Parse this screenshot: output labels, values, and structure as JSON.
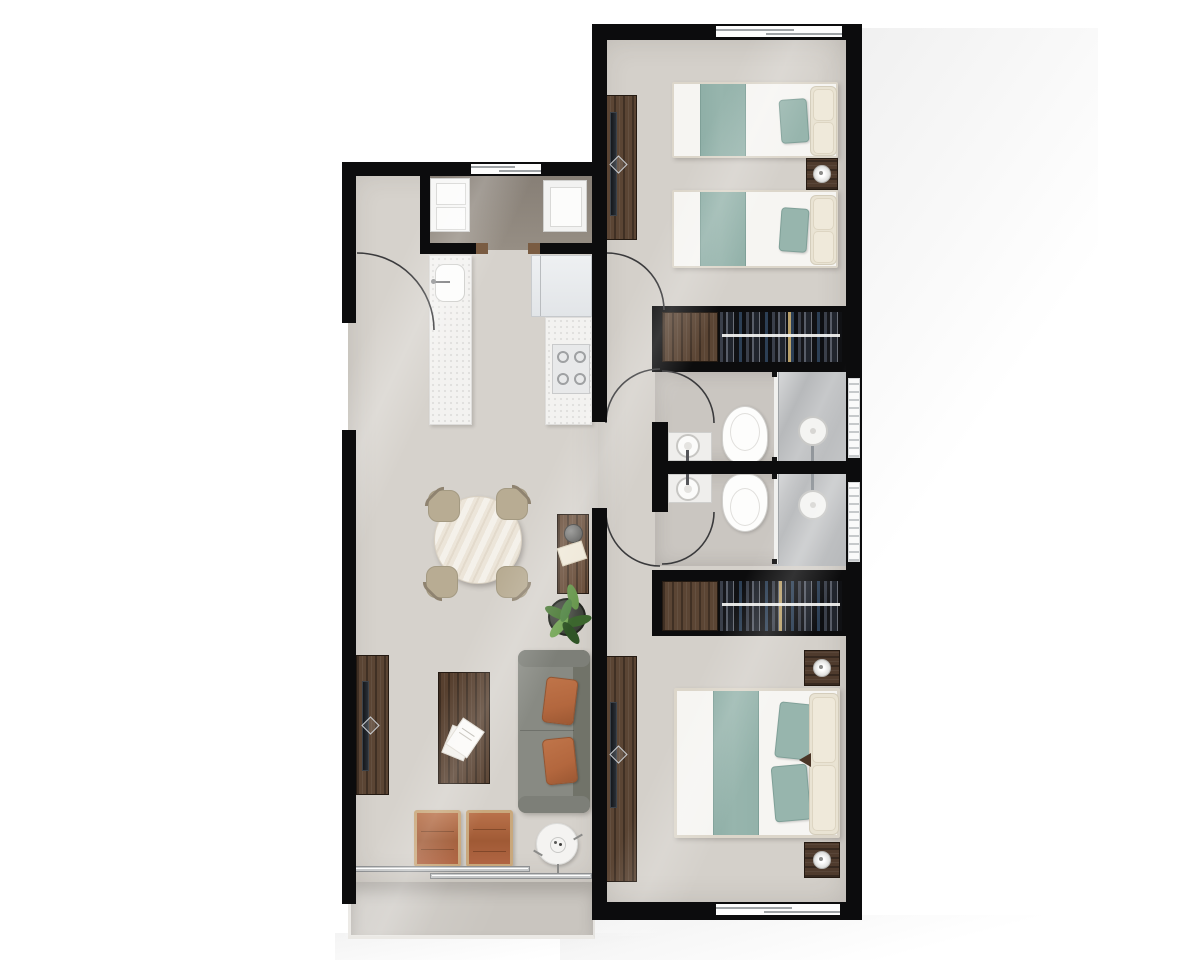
{
  "meta": {
    "title": "Two-bedroom apartment floor plan — photorealistic top-down 3D render",
    "view": "top-down",
    "text_on_image": "none"
  },
  "palette": {
    "bg": "#ffffff",
    "wall": "#0c0c0d",
    "floor": "#d6d2cc",
    "floor_right": "#d4d0ca",
    "laundry_floor": "#968e84",
    "bath_floor": "#cac6c1",
    "shower_floor": "#b7b9bb",
    "balcony_floor": "#c9c5bf",
    "wood": "#5b4534",
    "wood_dark": "#241a12",
    "wood_mid": "#6a4f3b",
    "teal": "#97b5ad",
    "teal_dark": "#7fa098",
    "cream": "#e9e3d3",
    "bed_white": "#f6f5f2",
    "sofa": "#888a83",
    "sofa_dark": "#717369",
    "orange": "#b3673e",
    "orange_dark": "#96542f",
    "tan": "#c9a87c",
    "chair": "#b8ac93",
    "chair_dark": "#8f8370",
    "counter": "#f3f2f0",
    "table": "#ece5d9",
    "plant": "#4f7d3b",
    "plant_dark": "#2f5426",
    "glass_line": "#9fa3a6",
    "arc": "#3a3a3c",
    "lamp_ring": "#b5b5b3"
  },
  "labels": {
    "plan": "Apartment floor plan",
    "bedroom1": "Bedroom with two twin beds",
    "bedroom2": "Master bedroom",
    "bath": "Bathroom",
    "kitchen": "Kitchen",
    "laundry": "Laundry nook",
    "dining": "Dining area",
    "living": "Living room",
    "balcony": "Balcony",
    "hallway": "Hallway",
    "twin_bed": "Twin bed with teal runner",
    "double_bed": "Double bed with teal runner",
    "wardrobe": "Built-in wardrobe with hanging clothes",
    "tv_console": "TV console",
    "nightstand": "Nightstand with lamp",
    "toilet": "Toilet",
    "vanity": "Vanity sink",
    "shower": "Glass shower with rain head",
    "washer": "Washing machine",
    "heater": "Utility appliance",
    "fridge": "Refrigerator",
    "stove": "Gas cooktop counter",
    "kitchen_sink": "Kitchen sink counter",
    "dining_table": "Round dining table",
    "chair": "Dining chair",
    "console_table": "Console table with decor",
    "plant": "Potted plant",
    "sofa": "Sofa with terracotta cushions",
    "coffee_table": "Coffee table with magazines",
    "ottoman": "Leather ottoman",
    "side_table": "Round side table",
    "sliding_door": "Sliding glass door",
    "window": "Window",
    "door_arc": "Door swing arc",
    "entry": "Entry door swing"
  },
  "rooms": [
    {
      "name": "kitchen-dining-living",
      "label": "Open kitchen, dining and living area",
      "furniture": [
        "washing machine",
        "utility appliance",
        "kitchen sink counter",
        "refrigerator",
        "gas cooktop counter",
        "round dining table with 4 chairs",
        "console table",
        "potted plant",
        "sofa with 2 terracotta cushions",
        "coffee table with magazines",
        "TV console",
        "2 leather ottomans",
        "round side table"
      ]
    },
    {
      "name": "balcony",
      "label": "Balcony with sliding glass door"
    },
    {
      "name": "bedroom-1",
      "label": "Bedroom with two twin beds",
      "furniture": [
        "2 twin beds with teal runners",
        "shared nightstand with lamp",
        "TV console",
        "built-in wardrobe"
      ]
    },
    {
      "name": "bathroom-1",
      "label": "Bathroom with vanity, toilet and glass shower"
    },
    {
      "name": "bathroom-2",
      "label": "Bathroom with vanity, toilet and glass shower"
    },
    {
      "name": "bedroom-2",
      "label": "Master bedroom with double bed",
      "furniture": [
        "double bed with teal runner",
        "2 nightstands with lamps",
        "TV console",
        "built-in wardrobe"
      ]
    },
    {
      "name": "hallway",
      "label": "Hallway connecting bedrooms and bathrooms"
    }
  ],
  "openings": {
    "entry_door_arcs": 1,
    "interior_door_arcs": 5,
    "windows": 5,
    "sliding_glass_doors": 2
  }
}
